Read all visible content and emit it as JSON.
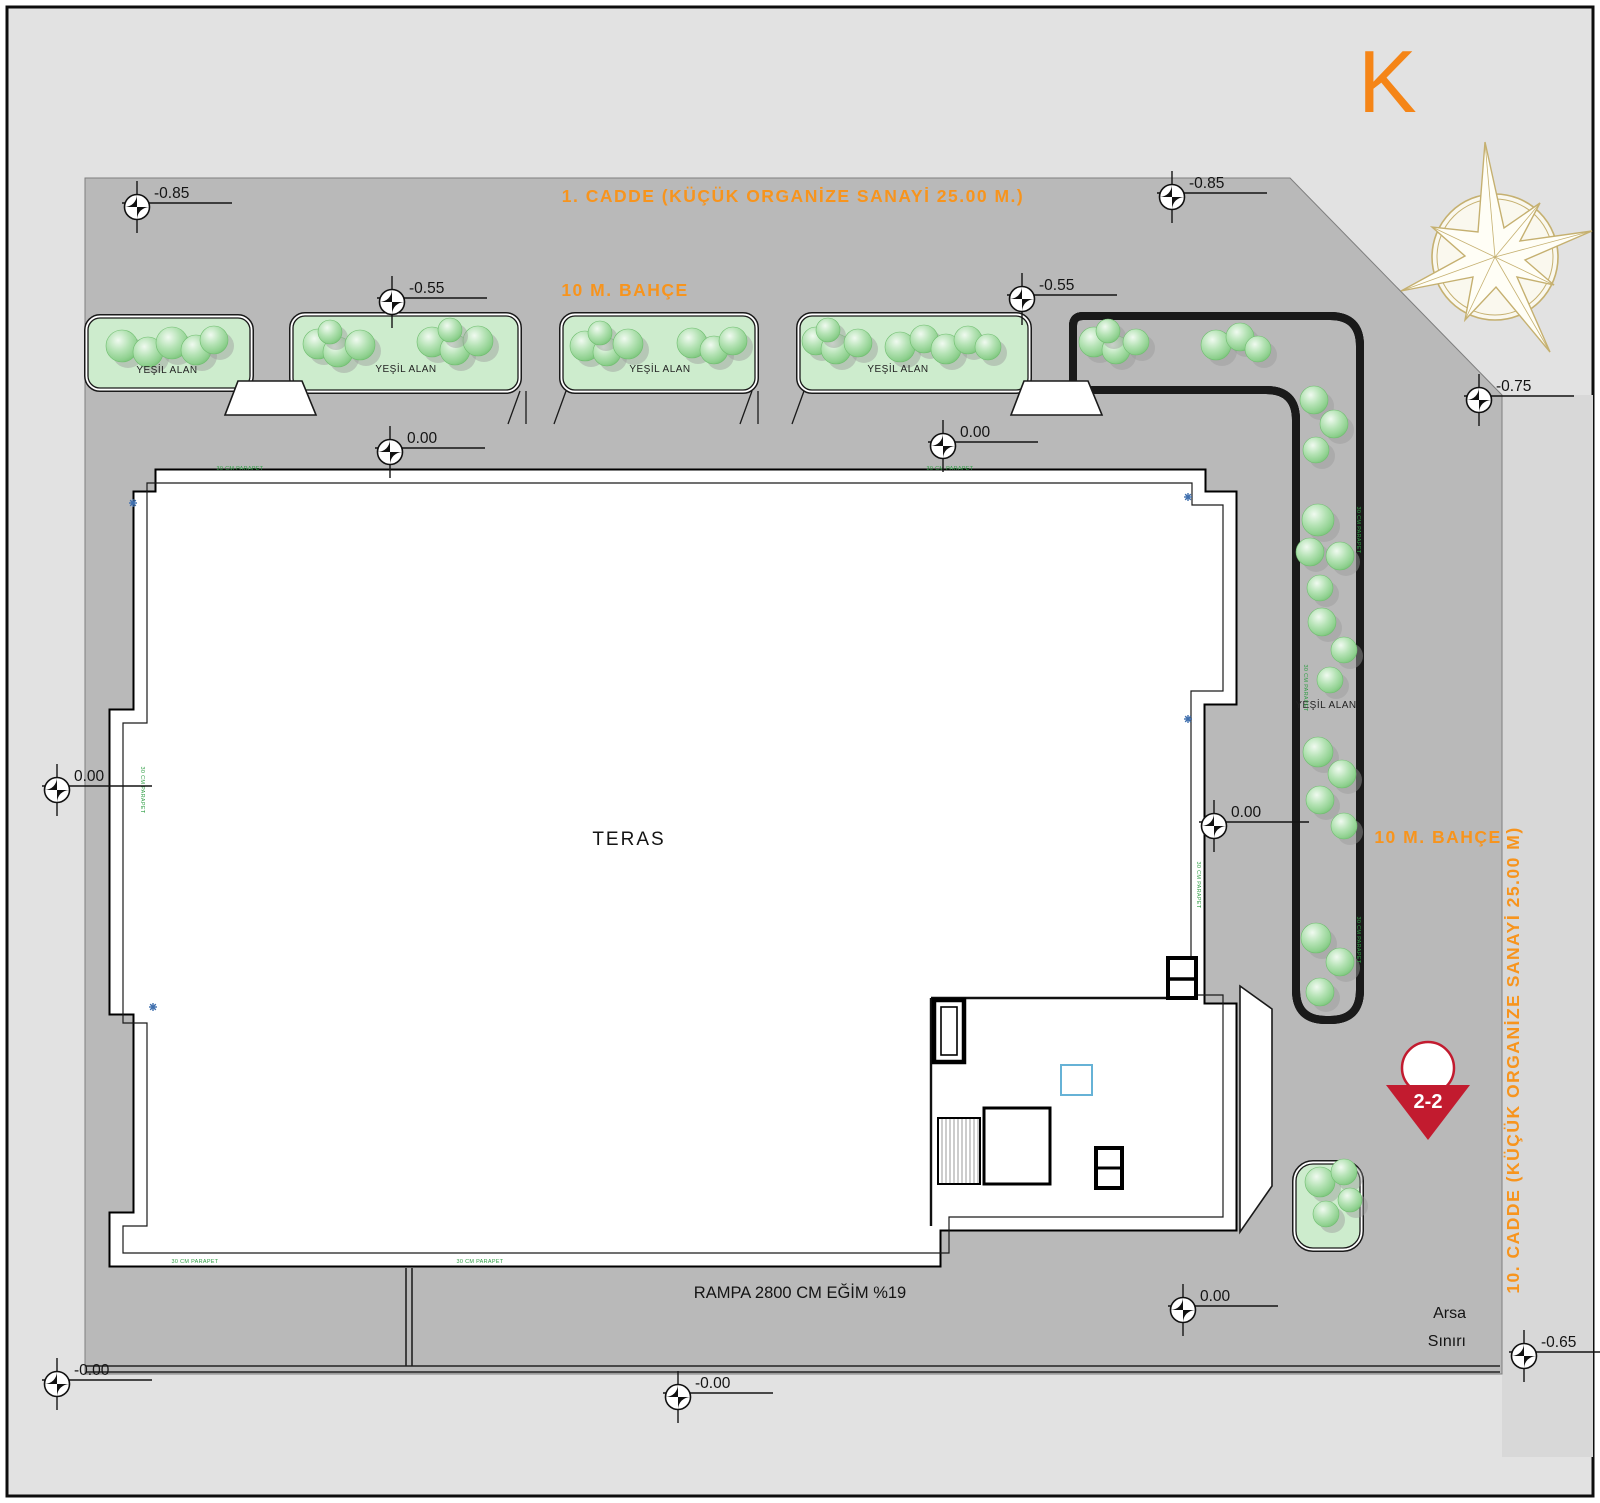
{
  "title": "site-plan",
  "colors": {
    "page": "#e2e2e2",
    "site": "#b9b9b9",
    "strip": "#d8d8d8",
    "green": "#cdeccd",
    "orange": "#f7941d",
    "red": "#c21b2f",
    "ink": "#141414"
  },
  "north": {
    "letter": "K"
  },
  "streets": {
    "top": "1. CADDE (KÜÇÜK ORGANİZE SANAYİ 25.00 M.)",
    "right": "10. CADDE (KÜÇÜK ORGANİZE SANAYİ 25.00 M)",
    "garden_top": "10 M. BAHÇE",
    "garden_right": "10 M. BAHÇE"
  },
  "labels": {
    "teras": "TERAS",
    "rampa": "RAMPA 2800 CM EĞİM %19",
    "arsa_line1": "Arsa",
    "arsa_line2": "Sınırı",
    "section": "2-2",
    "green_area": "YEŞİL ALAN",
    "parapet": "30 CM PARAPET"
  },
  "elevations": [
    {
      "v": "-0.85",
      "x": 137,
      "y": 207
    },
    {
      "v": "-0.85",
      "x": 1172,
      "y": 197
    },
    {
      "v": "-0.55",
      "x": 392,
      "y": 302
    },
    {
      "v": "-0.55",
      "x": 1022,
      "y": 299
    },
    {
      "v": "-0.75",
      "x": 1479,
      "y": 400
    },
    {
      "v": "0.00",
      "x": 390,
      "y": 452
    },
    {
      "v": "0.00",
      "x": 943,
      "y": 446
    },
    {
      "v": "0.00",
      "x": 57,
      "y": 790
    },
    {
      "v": "0.00",
      "x": 1214,
      "y": 826
    },
    {
      "v": "0.00",
      "x": 1183,
      "y": 1310
    },
    {
      "v": "-0.00",
      "x": 57,
      "y": 1384
    },
    {
      "v": "-0.00",
      "x": 678,
      "y": 1397
    },
    {
      "v": "-0.65",
      "x": 1524,
      "y": 1356
    }
  ],
  "green_label_positions": [
    {
      "x": 167,
      "y": 373
    },
    {
      "x": 406,
      "y": 372
    },
    {
      "x": 660,
      "y": 372
    },
    {
      "x": 898,
      "y": 372
    },
    {
      "x": 1326,
      "y": 708
    }
  ],
  "parapet_positions": [
    {
      "x": 240,
      "y": 470,
      "rot": 0
    },
    {
      "x": 950,
      "y": 470,
      "rot": 0
    },
    {
      "x": 195,
      "y": 1263,
      "rot": 0
    },
    {
      "x": 480,
      "y": 1263,
      "rot": 0
    },
    {
      "x": 141,
      "y": 790,
      "rot": 90
    },
    {
      "x": 1197,
      "y": 885,
      "rot": 90
    },
    {
      "x": 1357,
      "y": 530,
      "rot": 90
    },
    {
      "x": 1304,
      "y": 688,
      "rot": 90
    },
    {
      "x": 1357,
      "y": 940,
      "rot": 90
    }
  ],
  "drains": [
    {
      "x": 133,
      "y": 503
    },
    {
      "x": 153,
      "y": 1007
    },
    {
      "x": 1188,
      "y": 497
    },
    {
      "x": 1188,
      "y": 719
    }
  ],
  "trees": [
    [
      122,
      346,
      16
    ],
    [
      148,
      352,
      15
    ],
    [
      172,
      343,
      16
    ],
    [
      196,
      350,
      15
    ],
    [
      214,
      340,
      14
    ],
    [
      318,
      344,
      15
    ],
    [
      338,
      352,
      15
    ],
    [
      330,
      332,
      12
    ],
    [
      360,
      345,
      15
    ],
    [
      432,
      342,
      15
    ],
    [
      455,
      350,
      15
    ],
    [
      478,
      341,
      15
    ],
    [
      450,
      330,
      12
    ],
    [
      585,
      346,
      15
    ],
    [
      607,
      352,
      14
    ],
    [
      600,
      333,
      12
    ],
    [
      628,
      344,
      15
    ],
    [
      692,
      343,
      15
    ],
    [
      714,
      350,
      14
    ],
    [
      733,
      341,
      14
    ],
    [
      816,
      341,
      14
    ],
    [
      836,
      349,
      15
    ],
    [
      828,
      330,
      12
    ],
    [
      858,
      343,
      14
    ],
    [
      900,
      347,
      15
    ],
    [
      924,
      339,
      14
    ],
    [
      946,
      349,
      15
    ],
    [
      968,
      340,
      14
    ],
    [
      988,
      347,
      13
    ],
    [
      1094,
      342,
      15
    ],
    [
      1116,
      350,
      14
    ],
    [
      1108,
      331,
      12
    ],
    [
      1136,
      342,
      13
    ],
    [
      1216,
      345,
      15
    ],
    [
      1240,
      337,
      14
    ],
    [
      1258,
      349,
      13
    ],
    [
      1314,
      400,
      14
    ],
    [
      1334,
      424,
      14
    ],
    [
      1316,
      450,
      13
    ],
    [
      1318,
      520,
      16
    ],
    [
      1310,
      552,
      14
    ],
    [
      1340,
      556,
      14
    ],
    [
      1320,
      588,
      13
    ],
    [
      1322,
      622,
      14
    ],
    [
      1344,
      650,
      13
    ],
    [
      1330,
      680,
      13
    ],
    [
      1318,
      752,
      15
    ],
    [
      1342,
      774,
      14
    ],
    [
      1320,
      800,
      14
    ],
    [
      1344,
      826,
      13
    ],
    [
      1316,
      938,
      15
    ],
    [
      1340,
      962,
      14
    ],
    [
      1320,
      992,
      14
    ],
    [
      1320,
      1182,
      15
    ],
    [
      1344,
      1172,
      13
    ],
    [
      1326,
      1214,
      13
    ],
    [
      1350,
      1200,
      12
    ]
  ]
}
